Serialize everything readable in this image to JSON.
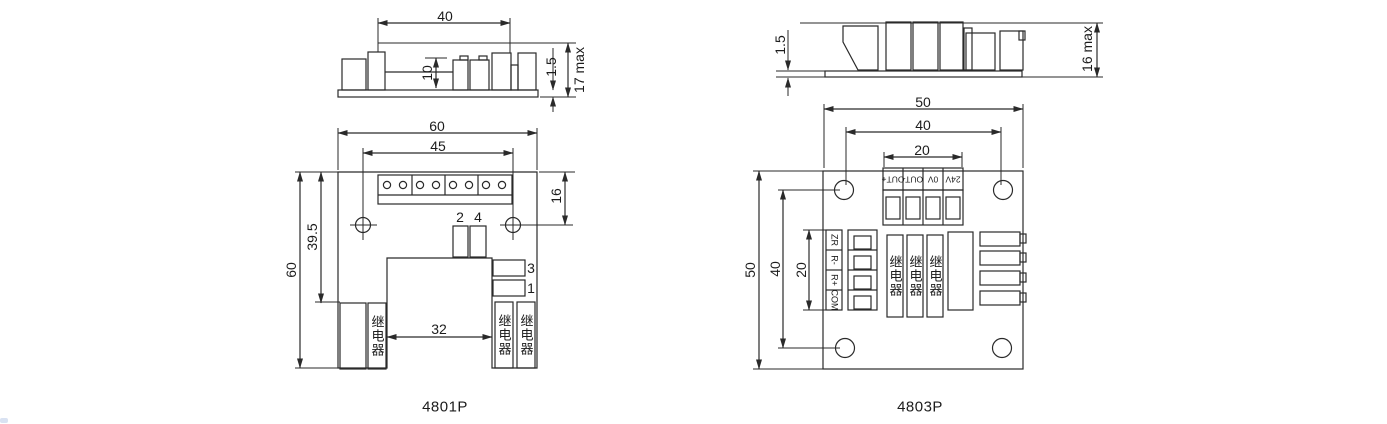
{
  "drawing_left": {
    "title": "4801P",
    "side_view": {
      "dim_width": "40",
      "dim_component_height": "10",
      "dim_pcb_thickness": "1.5",
      "dim_max_height": "17 max"
    },
    "top_view": {
      "dim_board_width": "60",
      "dim_hole_spacing": "45",
      "dim_edge_to_hole": "16",
      "dim_top_to_relay": "39.5",
      "dim_board_height": "60",
      "dim_notch_width": "32",
      "pin_2": "2",
      "pin_4": "4",
      "pin_3": "3",
      "pin_1": "1",
      "relay_text": "继电器"
    }
  },
  "drawing_right": {
    "title": "4803P",
    "side_view": {
      "dim_pcb_thickness": "1.5",
      "dim_max_height": "16 max"
    },
    "top_view": {
      "dim_board_width": "50",
      "dim_hole_spacing": "40",
      "dim_terminal_width": "20",
      "dim_board_height": "50",
      "dim_hole_spacing_v": "40",
      "dim_terminal_height": "20",
      "terminal_labels": [
        "OUT+",
        "OUT-",
        "0V",
        "24V"
      ],
      "io_labels": [
        "ZR",
        "R-",
        "R+",
        "COM"
      ],
      "relay_text": "继电器"
    }
  },
  "line_color": "#2a2a2a"
}
